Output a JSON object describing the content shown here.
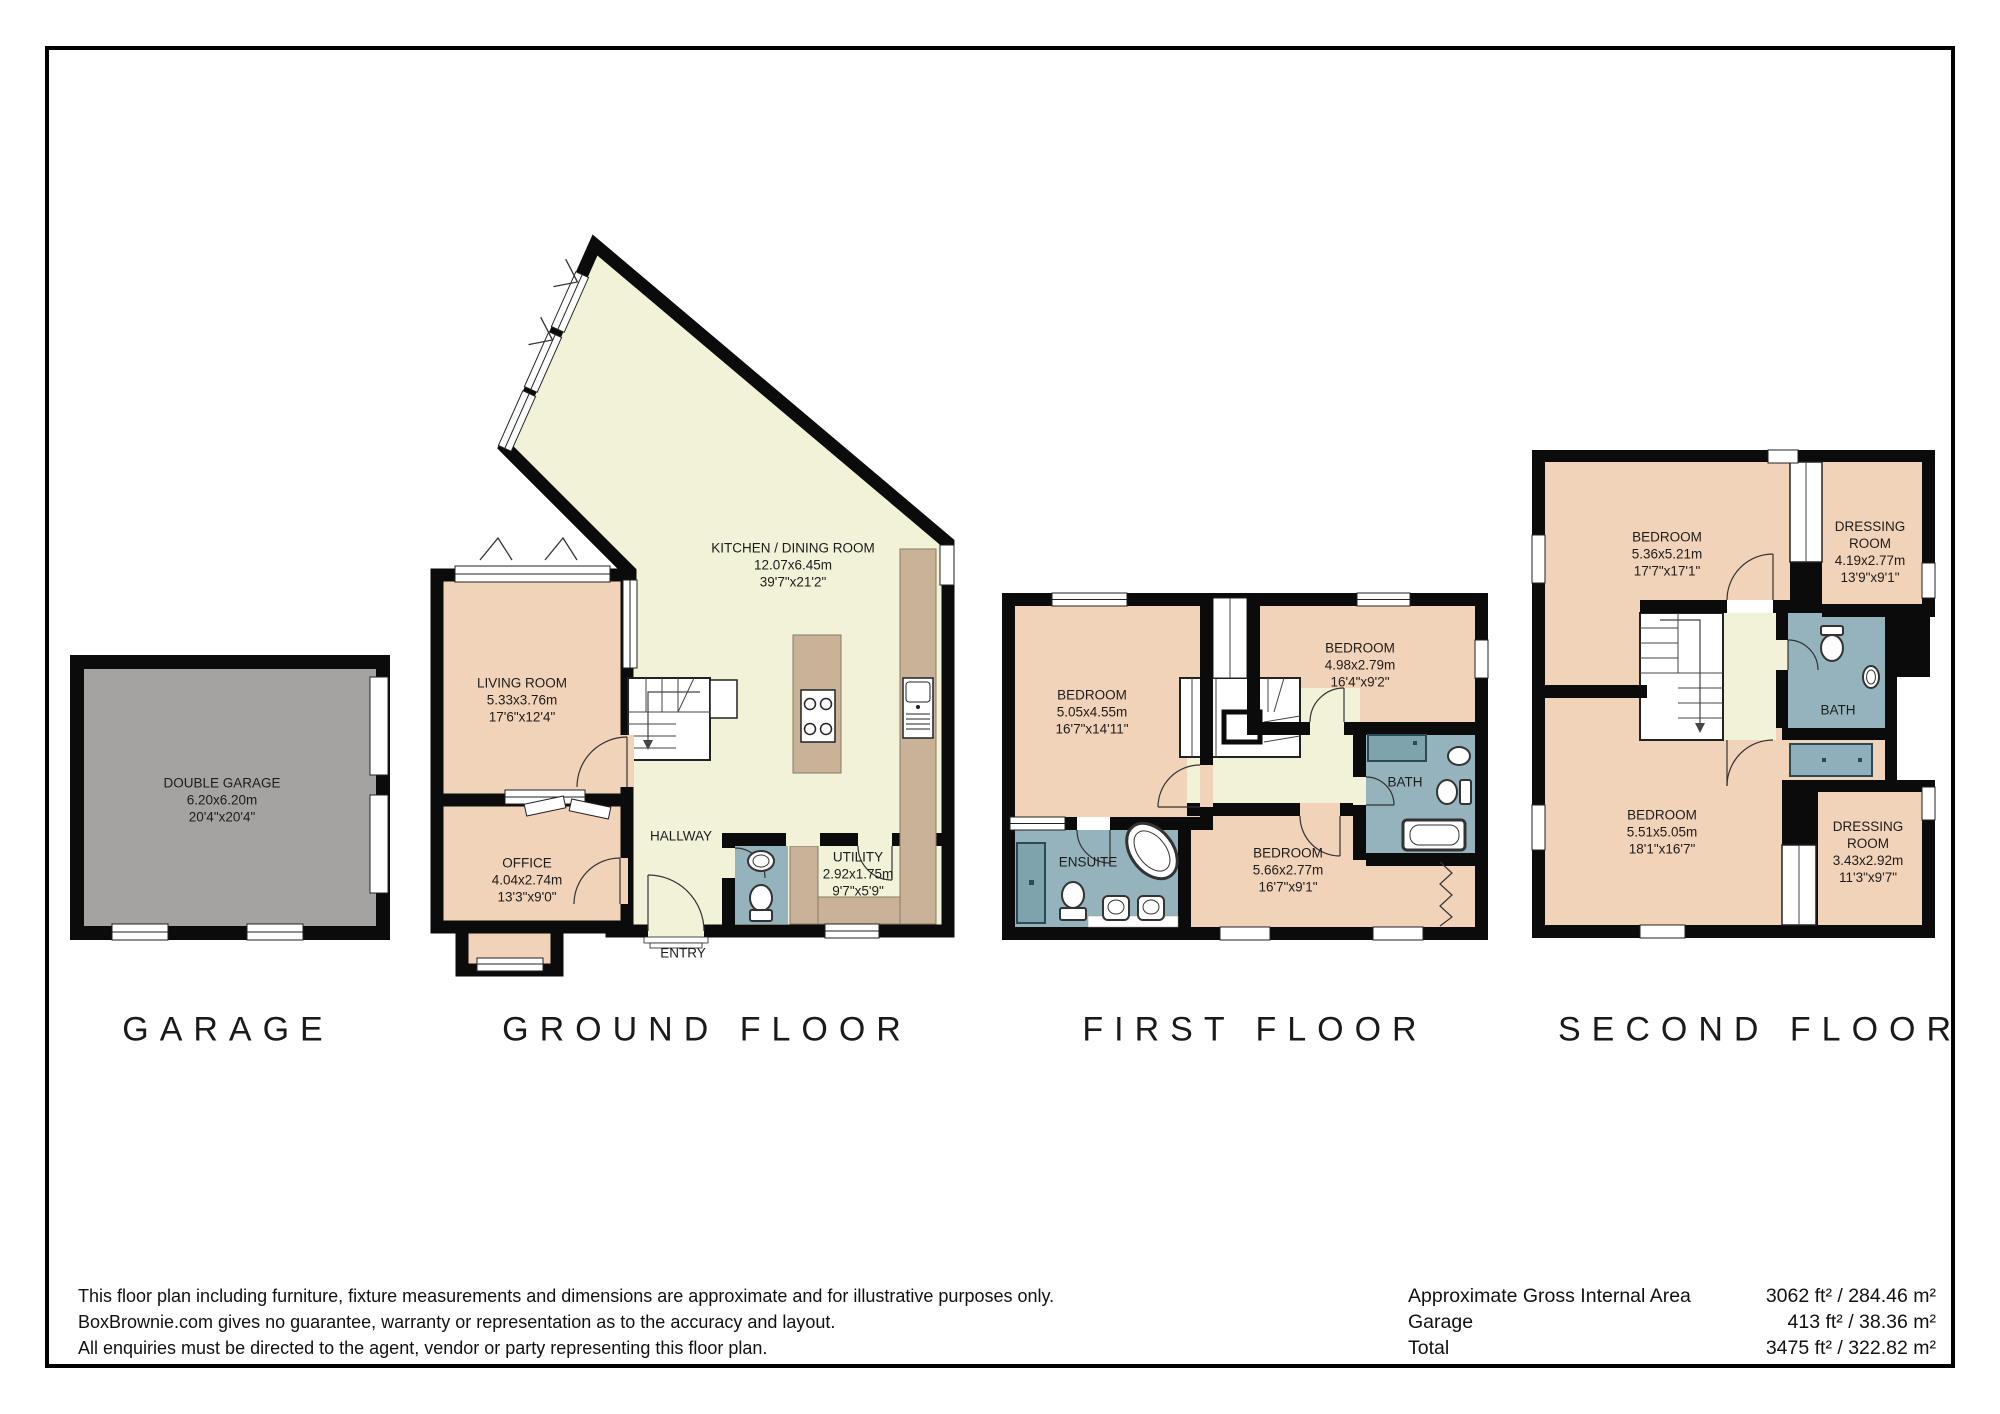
{
  "titles": {
    "garage": "GARAGE",
    "ground": "GROUND FLOOR",
    "first": "FIRST FLOOR",
    "second": "SECOND FLOOR"
  },
  "rooms": {
    "double_garage": {
      "name": "DOUBLE GARAGE",
      "metric": "6.20x6.20m",
      "imperial": "20'4\"x20'4\""
    },
    "living_room": {
      "name": "LIVING ROOM",
      "metric": "5.33x3.76m",
      "imperial": "17'6\"x12'4\""
    },
    "kitchen": {
      "name": "KITCHEN / DINING ROOM",
      "metric": "12.07x6.45m",
      "imperial": "39'7\"x21'2\""
    },
    "office": {
      "name": "OFFICE",
      "metric": "4.04x2.74m",
      "imperial": "13'3\"x9'0\""
    },
    "hallway": {
      "name": "HALLWAY"
    },
    "entry": {
      "name": "ENTRY"
    },
    "utility": {
      "name": "UTILITY",
      "metric": "2.92x1.75m",
      "imperial": "9'7\"x5'9\""
    },
    "ff_bedroom_1": {
      "name": "BEDROOM",
      "metric": "5.05x4.55m",
      "imperial": "16'7\"x14'11\""
    },
    "ff_bedroom_2": {
      "name": "BEDROOM",
      "metric": "4.98x2.79m",
      "imperial": "16'4\"x9'2\""
    },
    "ff_bedroom_3": {
      "name": "BEDROOM",
      "metric": "5.66x2.77m",
      "imperial": "16'7\"x9'1\""
    },
    "ensuite": {
      "name": "ENSUITE"
    },
    "ff_bath": {
      "name": "BATH"
    },
    "sf_bedroom_1": {
      "name": "BEDROOM",
      "metric": "5.36x5.21m",
      "imperial": "17'7\"x17'1\""
    },
    "sf_dressing_1": {
      "name": "DRESSING",
      "name2": "ROOM",
      "metric": "4.19x2.77m",
      "imperial": "13'9\"x9'1\""
    },
    "sf_bath": {
      "name": "BATH"
    },
    "sf_bedroom_2": {
      "name": "BEDROOM",
      "metric": "5.51x5.05m",
      "imperial": "18'1\"x16'7\""
    },
    "sf_dressing_2": {
      "name": "DRESSING",
      "name2": "ROOM",
      "metric": "3.43x2.92m",
      "imperial": "11'3\"x9'7\""
    }
  },
  "footer": {
    "disclaimer": [
      "This floor plan including furniture, fixture measurements and dimensions are approximate and for illustrative purposes only.",
      "BoxBrownie.com gives no guarantee, warranty or representation as to the accuracy and layout.",
      "All enquiries must be directed to the agent, vendor or party representing this floor plan."
    ],
    "areas": [
      {
        "label": "Approximate Gross Internal Area",
        "value": "3062 ft² / 284.46 m²"
      },
      {
        "label": "Garage",
        "value": "413 ft² / 38.36 m²"
      },
      {
        "label": "Total",
        "value": "3475 ft² / 322.82 m²"
      }
    ]
  },
  "colors": {
    "wall": "#0b0b0b",
    "room_tan": "#f1d3b9",
    "room_cream": "#f1f2d7",
    "room_blue": "#95b3bc",
    "fixture_blue": "#7fa3ad",
    "tub_blue": "#8fb0ba",
    "garage_gray": "#a5a3a1",
    "counter_tan": "#c9b298"
  }
}
